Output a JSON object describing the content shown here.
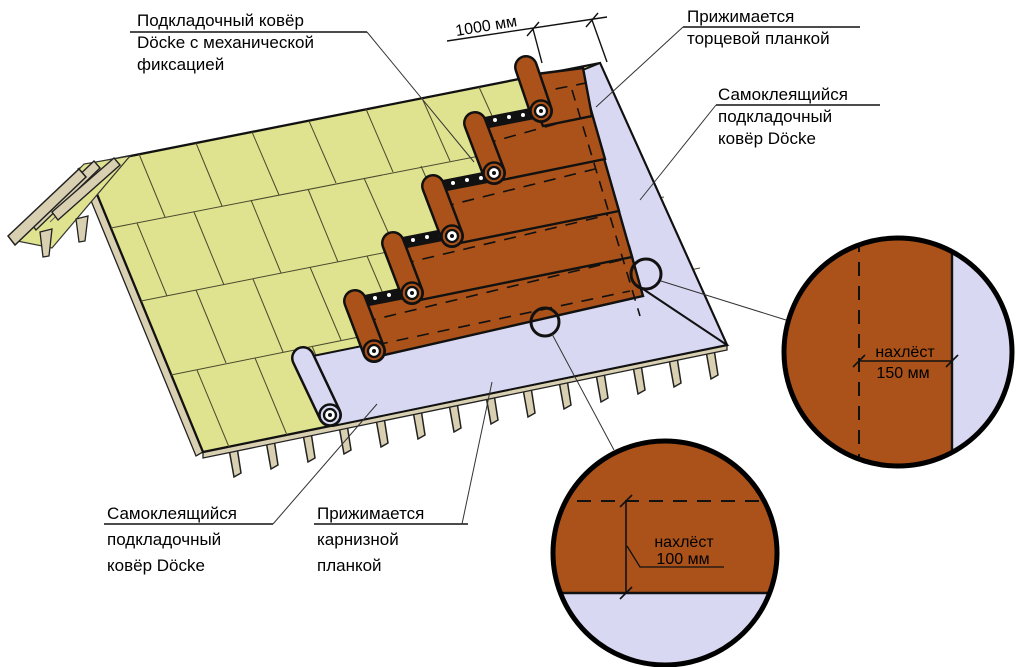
{
  "diagram": {
    "title": "Схема монтажа подкладочного ковра Döcke",
    "labels": {
      "underlayment_mechanical": {
        "line1": "Подкладочный ковёр",
        "line2": "Döcke с механической",
        "line3": "фиксацией"
      },
      "pressed_end_strip": {
        "line1": "Прижимается",
        "line2": "торцевой планкой"
      },
      "self_adhesive_right": {
        "line1": "Самоклеящийся",
        "line2": "подкладочный",
        "line3": "ковёр Döcke"
      },
      "self_adhesive_left": {
        "line1": "Самоклеящийся",
        "line2": "подкладочный",
        "line3": "ковёр Döcke"
      },
      "pressed_eaves_strip": {
        "line1": "Прижимается",
        "line2": "карнизной",
        "line3": "планкой"
      }
    },
    "dimensions": {
      "course_width": "1000 мм",
      "overlap_side": {
        "line1": "нахлёст",
        "line2": "150 мм"
      },
      "overlap_bottom": {
        "line1": "нахлёст",
        "line2": "100 мм"
      }
    },
    "colors": {
      "underlayment_brown": "#AA5219",
      "self_adhesive_lavender": "#D9D8F3",
      "deck_osb": "#DFE28E",
      "wood_tan": "#D9D0B2",
      "outline": "#111111"
    }
  }
}
